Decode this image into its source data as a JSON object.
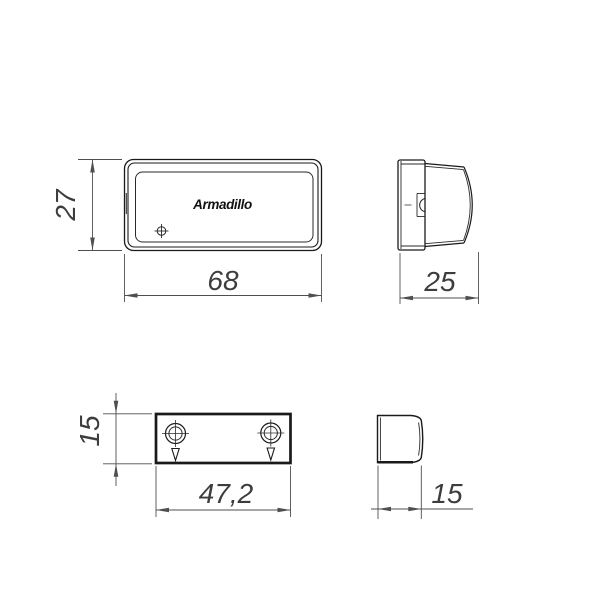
{
  "drawing": {
    "type": "technical-drawing",
    "subject": "door latch body and strike plate, four orthographic views",
    "logo_text": "Armadillo",
    "colors": {
      "background": "#ffffff",
      "contour_line": "#1a1a1a",
      "dimension_line": "#4f4f4f",
      "dimension_text": "#3d3d3d"
    },
    "views": {
      "body_front": {
        "label": "latch-body-front-view",
        "width": "68",
        "height": "27"
      },
      "body_side": {
        "label": "latch-body-side-view",
        "depth": "25"
      },
      "plate_front": {
        "label": "strike-plate-front-view",
        "width": "47,2",
        "height": "15"
      },
      "plate_side": {
        "label": "strike-plate-side-view",
        "depth": "15"
      }
    }
  }
}
